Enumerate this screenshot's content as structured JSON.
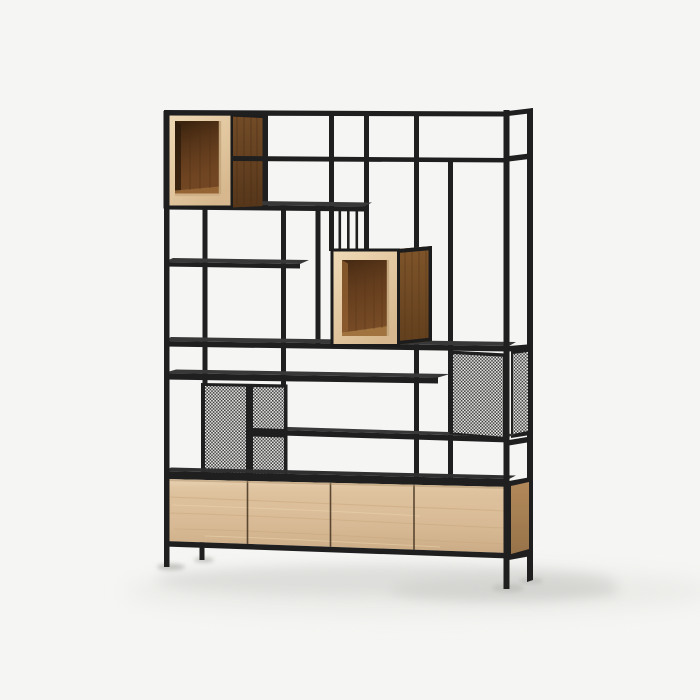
{
  "scene": {
    "type": "product-photo",
    "subject": "Industrial shelving unit: black steel frame room divider with oak display boxes, perforated mesh panels and a four-door oak sideboard base, on a plain light studio background",
    "background_color": "#f5f5f3",
    "palette": {
      "frame_black": "#1f1f1f",
      "shelf_surface": "#383838",
      "cabinet_top_surface": "#2f2f2f",
      "oak_light": "#e9d2ad",
      "oak_door": "#dcbf9b",
      "oak_cabinet_side": "#c79d6c",
      "walnut_dark": "#6b4524",
      "walnut_side_lit": "#84582b",
      "box_interior": "#6e4422",
      "mesh_light": "#efefed",
      "mesh_dark": "#3c3c3c",
      "shadow_soft": "#dededb",
      "shadow_leg": "#c4c4c1"
    },
    "components": {
      "open_display_boxes": 2,
      "oak_doors": 4,
      "mesh_panels": 3,
      "shelves": 6,
      "vertical_slats": 3,
      "legs": 4
    }
  }
}
